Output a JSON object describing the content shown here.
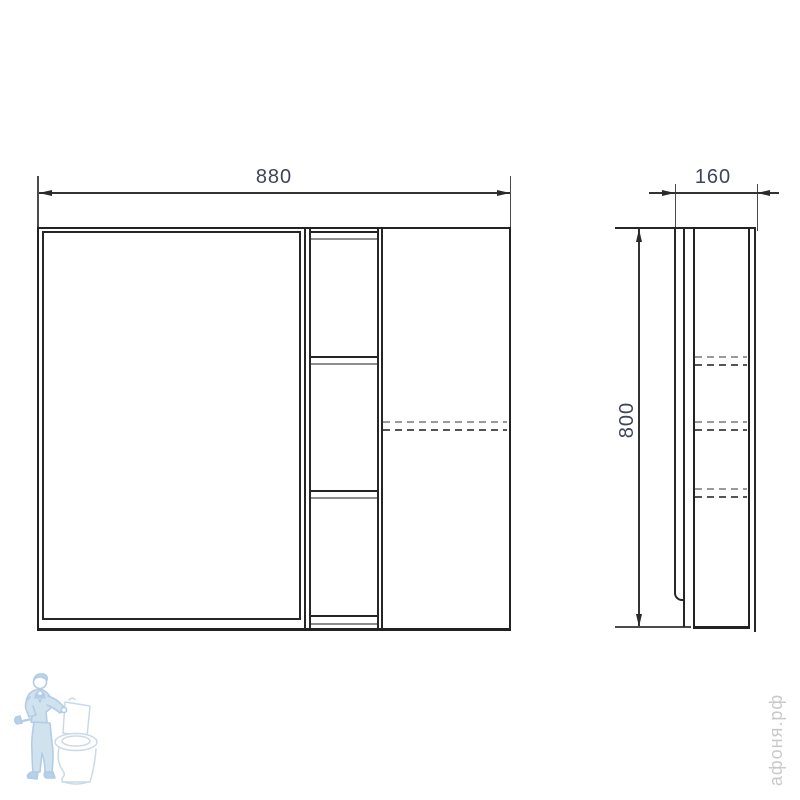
{
  "front_view": {
    "width_label": "880"
  },
  "side_view": {
    "depth_label": "160",
    "height_label": "800"
  },
  "watermark": {
    "text": "афоня.рф",
    "logo_icon": "plumber-toilet"
  },
  "colors": {
    "background": "#ffffff",
    "line": "#262626",
    "dim_text": "#3f4456",
    "shelf_shadow": "#8d8d8d",
    "dash_dark": "#555555",
    "dash_light": "#9a9a9a",
    "watermark_text": "#c9c9c9",
    "logo_outline": "#a5c4e2",
    "logo_fill": "#cadded"
  }
}
